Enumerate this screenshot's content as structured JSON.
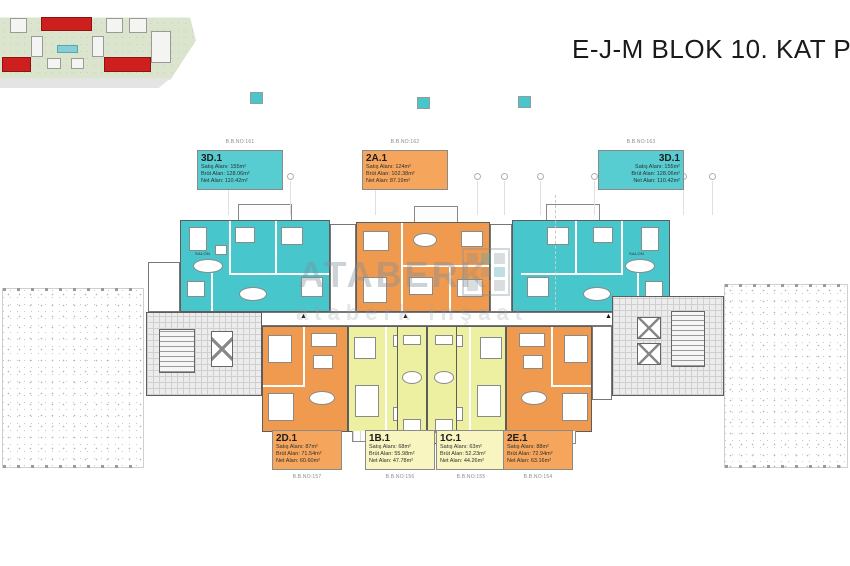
{
  "title": "E-J-M BLOK 10. KAT PLANI",
  "watermark": {
    "brand": "ATABERK",
    "sub": "ataberk inşaat"
  },
  "room_label": "SALON",
  "colors": {
    "tealL": "#57cdd2",
    "tealU": "#47c6cc",
    "orangeL": "#f5a65c",
    "orangeU": "#f09a50",
    "yellowL": "#f8f5c0",
    "yellowU": "#edf0a0",
    "site_red": "#ce1f1f",
    "pool": "#86cfd8"
  },
  "units": {
    "top": [
      {
        "code": "3D.1",
        "bbno": "B.B.NO:161",
        "satis": "Satış Alanı: 155m²",
        "brut": "Brüt Alan: 128.06m²",
        "net": "Net Alan: 110.42m²"
      },
      {
        "code": "2A.1",
        "bbno": "B.B.NO:162",
        "satis": "Satış Alanı: 124m²",
        "brut": "Brüt Alan: 102.38m²",
        "net": "Net Alan: 87.19m²"
      },
      {
        "code": "3D.1",
        "bbno": "B.B.NO:163",
        "satis": "Satış Alanı: 155m²",
        "brut": "Brüt Alan: 128.06m²",
        "net": "Net Alan: 110.42m²"
      }
    ],
    "bottom": [
      {
        "code": "2D.1",
        "bbno": "B.B.NO:157",
        "satis": "Satış Alanı: 87m²",
        "brut": "Brüt Alan: 71.54m²",
        "net": "Net Alan: 60.60m²"
      },
      {
        "code": "1B.1",
        "bbno": "B.B.NO:156",
        "satis": "Satış Alanı: 68m²",
        "brut": "Brüt Alan: 55.98m²",
        "net": "Net Alan: 47.78m²"
      },
      {
        "code": "1C.1",
        "bbno": "B.B.NO:155",
        "satis": "Satış Alanı: 63m²",
        "brut": "Brüt Alan: 52.23m²",
        "net": "Net Alan: 44.26m²"
      },
      {
        "code": "2E.1",
        "bbno": "B.B.NO:154",
        "satis": "Satış Alanı: 88m²",
        "brut": "Brüt Alan: 72.94m²",
        "net": "Net Alan: 63.16m²"
      }
    ]
  }
}
